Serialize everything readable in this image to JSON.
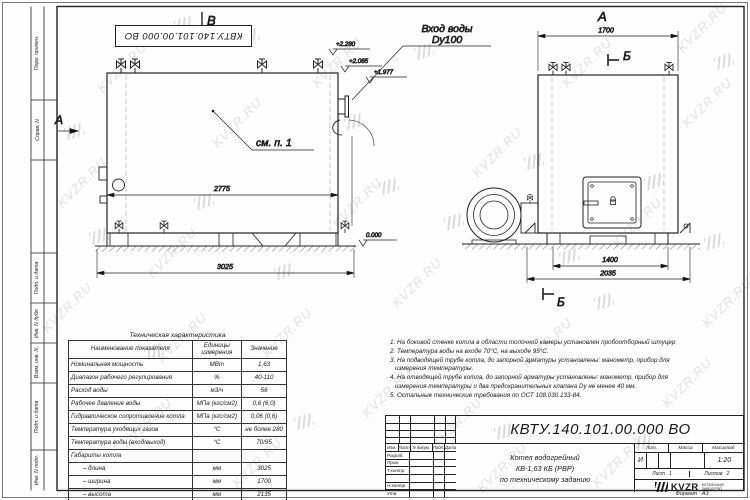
{
  "sheet": {
    "watermark_text": "KVZR.RU",
    "stamp_code": "КВТУ.140.101.00.000 ВО",
    "format_label": "Формат",
    "format_value": "А3",
    "side_labels": [
      "Перв. примен.",
      "Справ. N",
      "Подп. и дата",
      "Инв. N дубл.",
      "Взам. инв. N",
      "Подп. и дата",
      "Инв. N подл."
    ]
  },
  "drawing": {
    "front_view": {
      "view_mark": "В",
      "direction_arrow": "А",
      "inlet_line1": "Вход воды",
      "inlet_line2": "Dy100",
      "see_note_ref": "см. п. 1",
      "dim_inner_width": "2775",
      "dim_base_width": "3025",
      "elevation_top": "+2.280",
      "elevation_mid": "+2.085",
      "elevation_inlet": "+1.977",
      "elevation_zero": "0.000"
    },
    "side_view": {
      "view_label": "А",
      "dim_top_width": "1700",
      "section_mark_top": "Б",
      "section_mark_bottom": "Б",
      "dim_base_inner": "1400",
      "dim_base_outer": "2035"
    }
  },
  "tech_table": {
    "title": "Техническая характеристика",
    "headers": [
      "Наименование показателя",
      "Единицы измерения",
      "Значение"
    ],
    "rows": [
      [
        "Номинальная мощность",
        "МВт",
        "1,63"
      ],
      [
        "Диапазон рабочего регулирования",
        "%",
        "40-110"
      ],
      [
        "Расход воды",
        "м3/ч",
        "56"
      ],
      [
        "Рабочее давление воды",
        "МПа (кгс/см2)",
        "0,6 (6,0)"
      ],
      [
        "Гидравлическое сопротивление котла",
        "МПа (кгс/см2)",
        "0,06 (0,6)"
      ],
      [
        "Температура уходящих газов",
        "°С",
        "не более 280"
      ],
      [
        "Температура воды (вход/выход)",
        "°С",
        "70/95"
      ],
      [
        "Габариты котла",
        "",
        ""
      ],
      [
        "– длина",
        "мм",
        "3025"
      ],
      [
        "– ширина",
        "мм",
        "1700"
      ],
      [
        "– высота",
        "мм",
        "2135"
      ]
    ]
  },
  "notes": {
    "lines": [
      "1.  На боковой стенке котла в области топочной камеры установлен пробоотборный штуцер",
      "2.  Температура воды на входе  70°С,  на выходе  95°С.",
      "3.  На подводящей трубе котла, до запорной арматуры установлены:  манометр,  прибор для",
      "измерения температуры.",
      "4.  На отводящей трубе котла, до запорной арматуры установлены:  манометр,  прибор для",
      "измерения температуры и два предохранительных клапана  Dy не менее  40 мм.",
      "5.  Остальные технические требования по ОСТ  108.030.133-84."
    ]
  },
  "title_block": {
    "doc_number": "КВТУ.140.101.00.000  ВО",
    "rev_col_headers": [
      "Изм.",
      "Лист",
      "N докум.",
      "Подп.",
      "Дата"
    ],
    "role_labels": [
      "Разраб.",
      "Пров.",
      "Т.контр.",
      "",
      "Н.контр.",
      "Утв."
    ],
    "description_lines": [
      "Котел водогрейный",
      "КВ-1,63 КБ  (РВР)",
      "по техническому заданию"
    ],
    "lit_label": "Лит.",
    "lit_value": "И",
    "mass_label": "Масса",
    "mass_value": "",
    "scale_label": "Масштаб",
    "scale_value": "1:20",
    "sheet_label": "Лист",
    "sheet_value": "1",
    "sheets_label": "Листов",
    "sheets_value": "2",
    "company": "KVZR",
    "company_sub1": "КОТЕЛЬНЫЙ",
    "company_sub2": "ЗАВОД РЭП"
  }
}
